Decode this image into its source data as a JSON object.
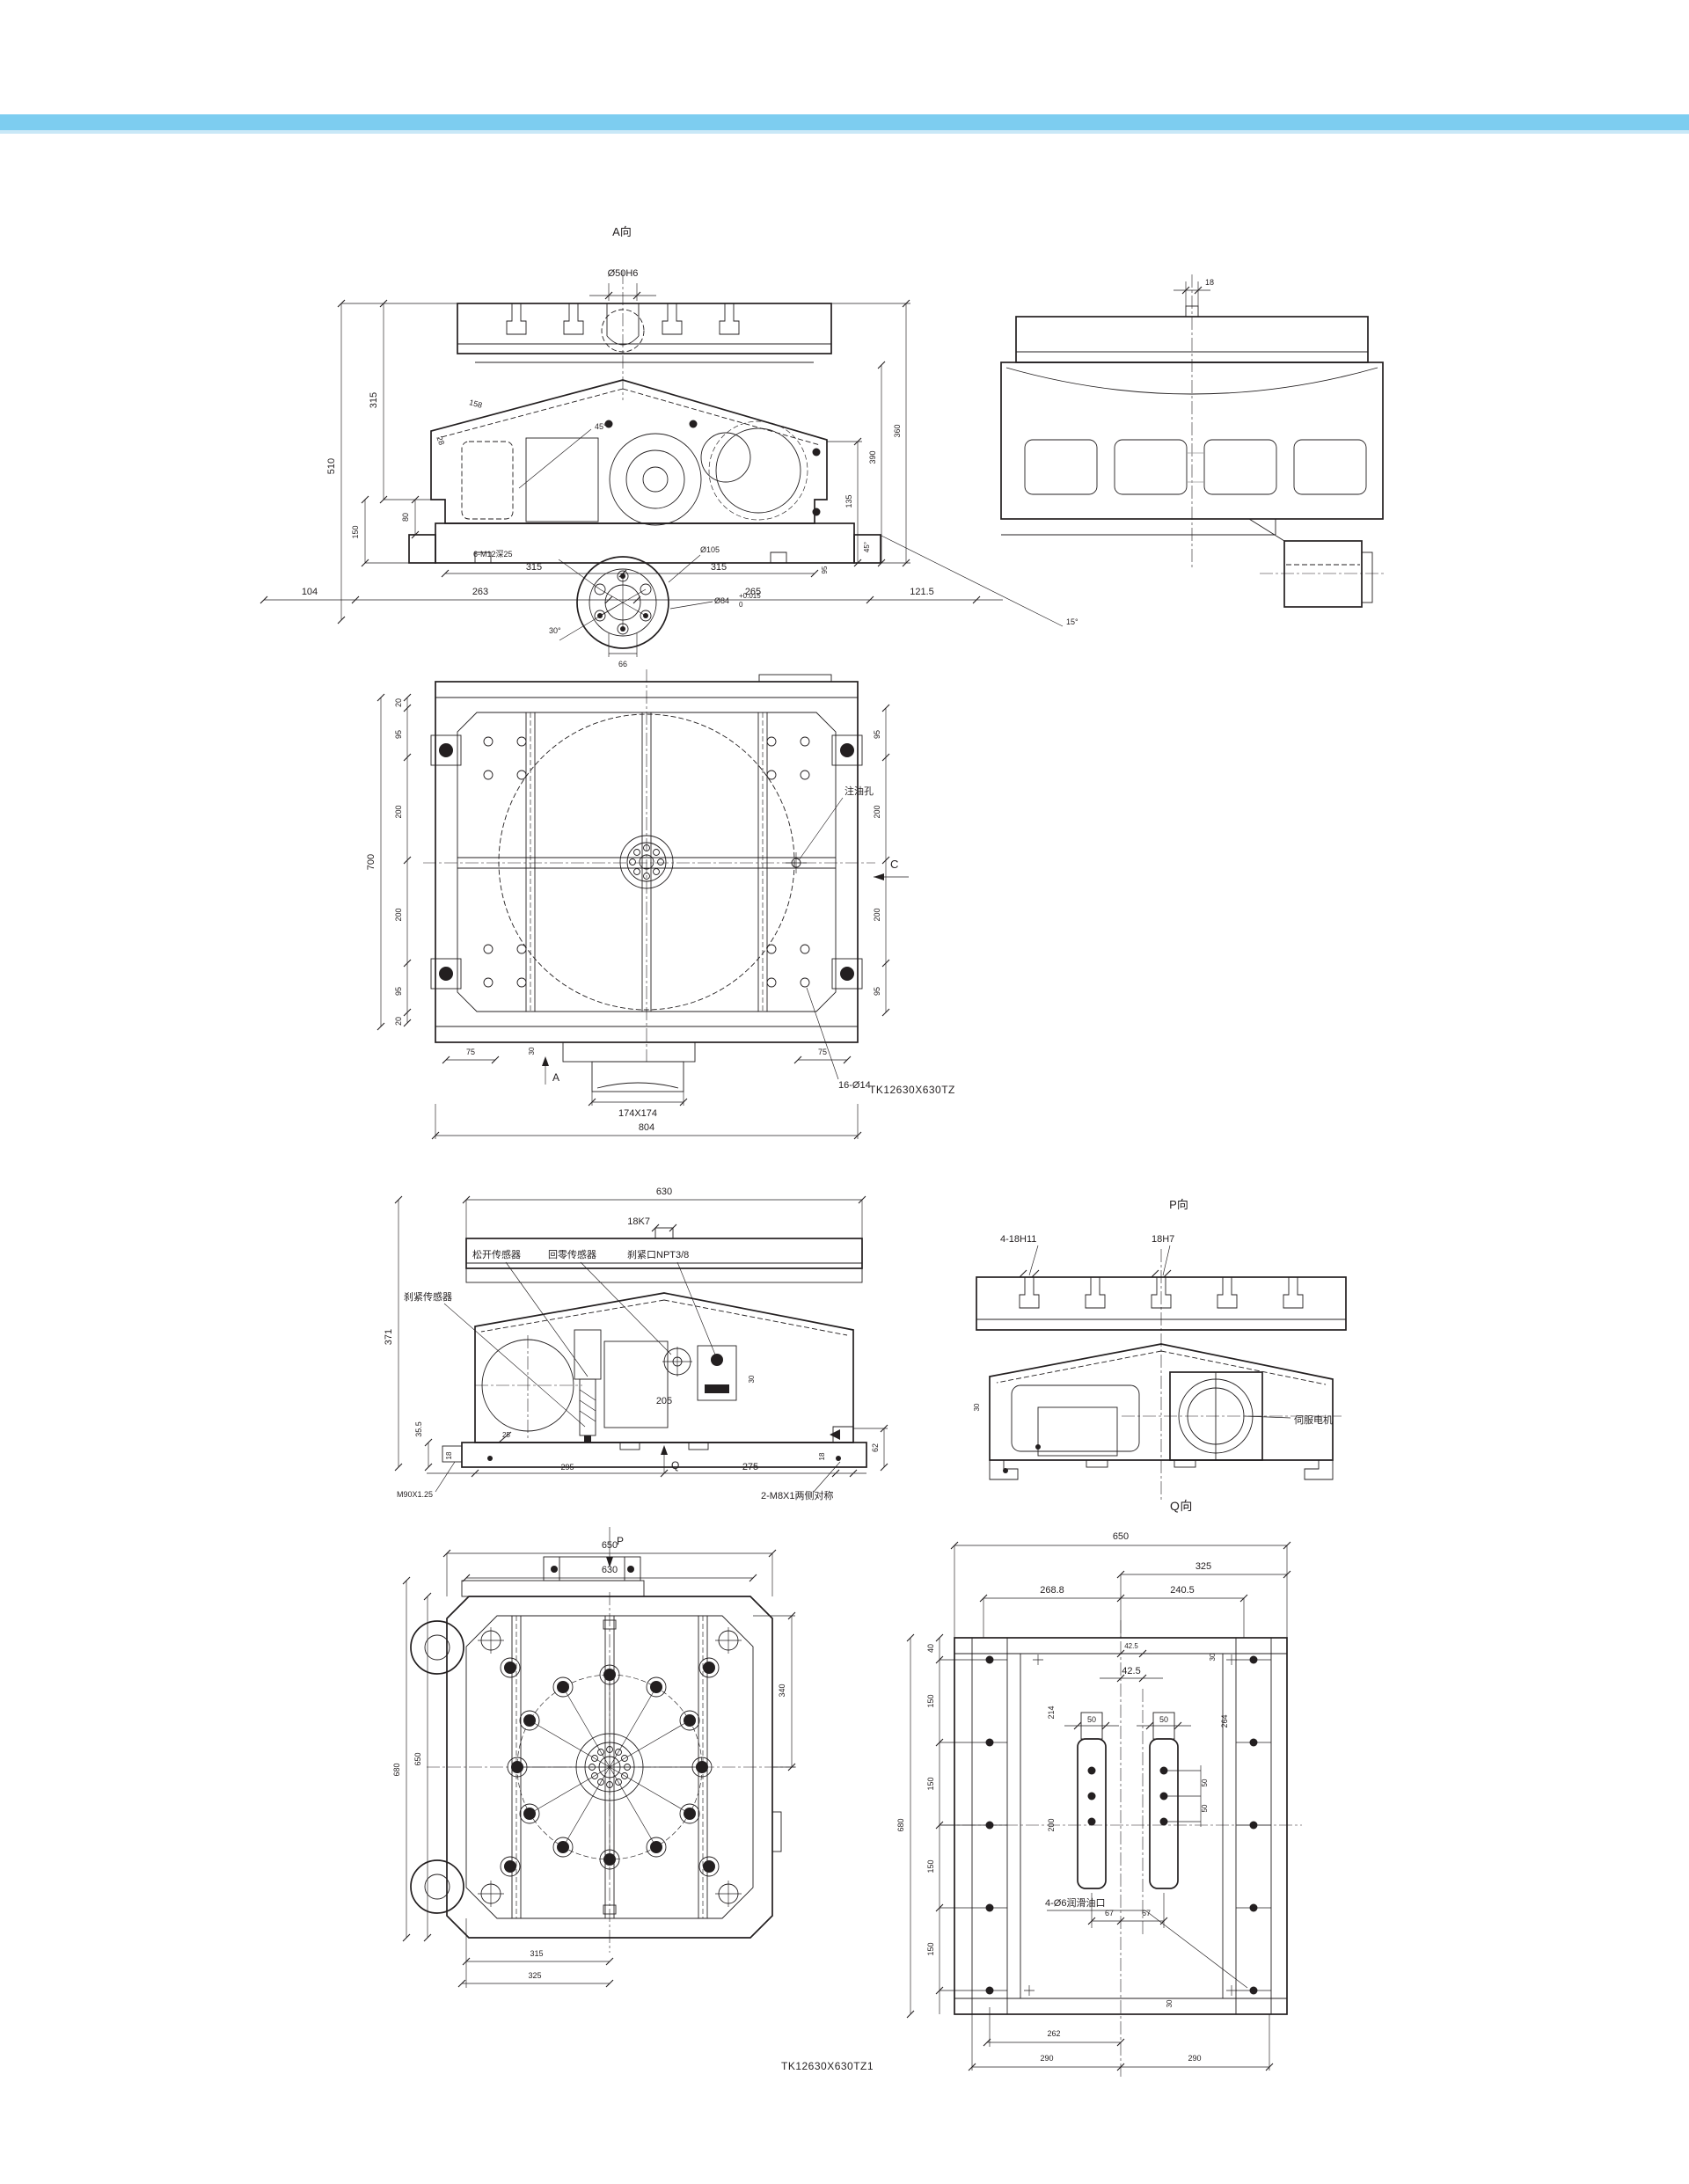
{
  "page": {
    "accent_bar": "#7dcdf0",
    "accent_bar_light": "#c9e8f7"
  },
  "part_numbers": {
    "plan": "TK12630X630TZ",
    "bottom": "TK12630X630TZ1"
  },
  "view_a": {
    "title": "A向",
    "dim_spigot": "Ø50H6",
    "dim_510": "510",
    "dim_315_left": "315",
    "dim_80": "80",
    "dim_150": "150",
    "dim_158": "158",
    "dim_28": "28",
    "dim_45_center": "45°",
    "dim_135": "135",
    "dim_390": "390",
    "dim_360": "360",
    "dim_45_right": "45°",
    "dim_315_mid_left": "315",
    "dim_315_mid_right": "315",
    "dim_95": "95",
    "label_bolts": "6-M12深25",
    "dim_d105": "Ø105",
    "dim_d84": "Ø84",
    "tol_up": "+0.015",
    "tol_dn": "0",
    "dim_30deg": "30°",
    "dim_66": "66",
    "dim_104": "104",
    "dim_263": "263",
    "dim_265": "265",
    "dim_121_5": "121.5",
    "dim_15deg": "15°"
  },
  "side_view": {
    "dim_18": "18"
  },
  "plan_view": {
    "label_c": "C",
    "label_oil_hole": "注油孔",
    "label_holes": "16-Ø14",
    "label_a": "A",
    "dim_30": "30",
    "dim_174": "174X174",
    "dim_804": "804",
    "dim_75_left": "75",
    "dim_75_right": "75",
    "dim_700": "700",
    "left_chain": [
      "20",
      "95",
      "200",
      "200",
      "95",
      "20"
    ],
    "right_chain": [
      "95",
      "200",
      "200",
      "95"
    ]
  },
  "front_view": {
    "dim_630": "630",
    "dim_18k7": "18K7",
    "label_release_sensor": "松开传感器",
    "label_home_sensor": "回零传感器",
    "label_brake_port": "刹紧口NPT3/8",
    "label_brake_sensor": "刹紧传感器",
    "dim_371": "371",
    "dim_35_5": "35.5",
    "dim_18_left": "18",
    "dim_25": "25",
    "dim_295": "295",
    "dim_205": "205",
    "dim_275": "275",
    "dim_18_right": "18",
    "dim_62": "62",
    "dim_30": "30",
    "label_q": "Q",
    "label_m90": "M90X1.25",
    "label_m8": "2-M8X1两侧对称"
  },
  "view_p": {
    "title": "P向",
    "label_slots": "4-18H11",
    "label_center_slot": "18H7",
    "label_servo": "伺服电机",
    "dim_30": "30"
  },
  "view_q": {
    "title": "Q向",
    "dim_650": "650",
    "dim_325": "325",
    "dim_268_8": "268.8",
    "dim_240_5": "240.5",
    "dim_42_5_small": "42.5",
    "dim_42_5": "42.5",
    "dim_30_top": "30",
    "dim_30_bottom": "30",
    "dim_214": "214",
    "dim_200": "200",
    "dim_264": "264",
    "dim_50_slot_left": "50",
    "dim_50_slot_right": "50",
    "dim_50_right_a": "50",
    "dim_50_right_b": "50",
    "dim_67_left": "67",
    "dim_67_right": "67",
    "dim_680": "680",
    "dim_40": "40",
    "dim_150_list": [
      "150",
      "150",
      "150",
      "150"
    ],
    "label_oil_ports": "4-Ø6润滑油口",
    "dim_262": "262",
    "dim_290_left": "290",
    "dim_290_right": "290"
  },
  "bottom_view": {
    "label_p": "P",
    "dim_650_top": "650",
    "dim_630": "630",
    "dim_680": "680",
    "dim_650_left": "650",
    "dim_340": "340",
    "dim_315": "315",
    "dim_325": "325"
  }
}
